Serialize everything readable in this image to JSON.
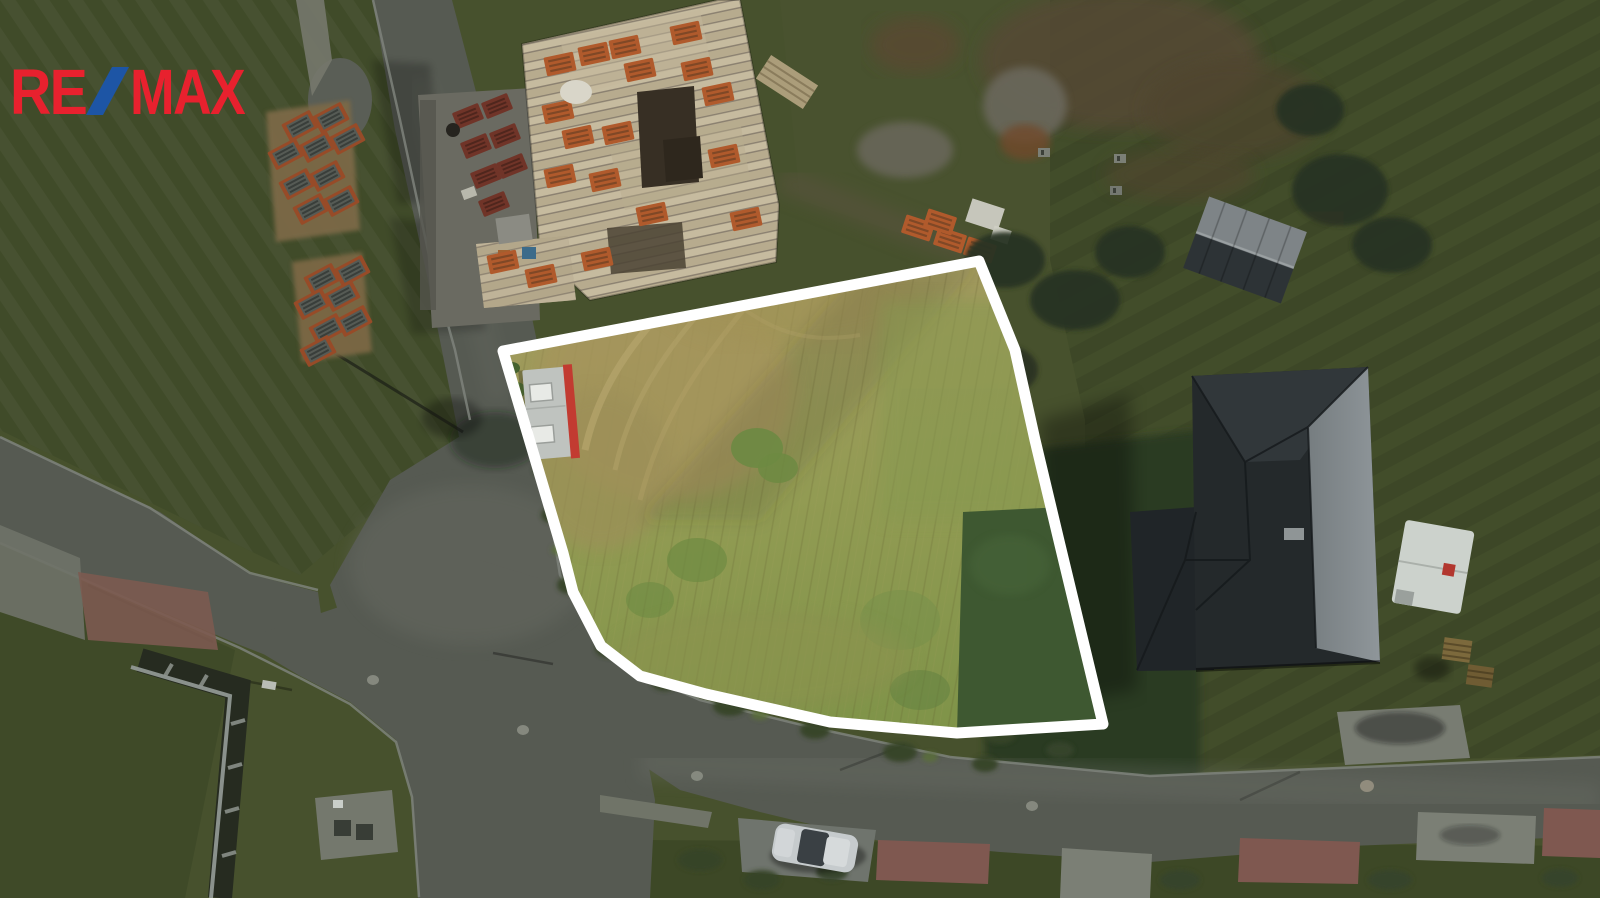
{
  "brand": {
    "re": "RE",
    "slash": "/",
    "max": "MAX",
    "red": "#e8212e",
    "blue": "#1d55a5"
  },
  "annotation": {
    "boundary_color": "#ffffff",
    "outline_points": "503,351 979,261 1015,350 1035,440 1060,545 1103,724 957,733 830,722 706,694 640,676 601,646 573,592 563,553"
  }
}
